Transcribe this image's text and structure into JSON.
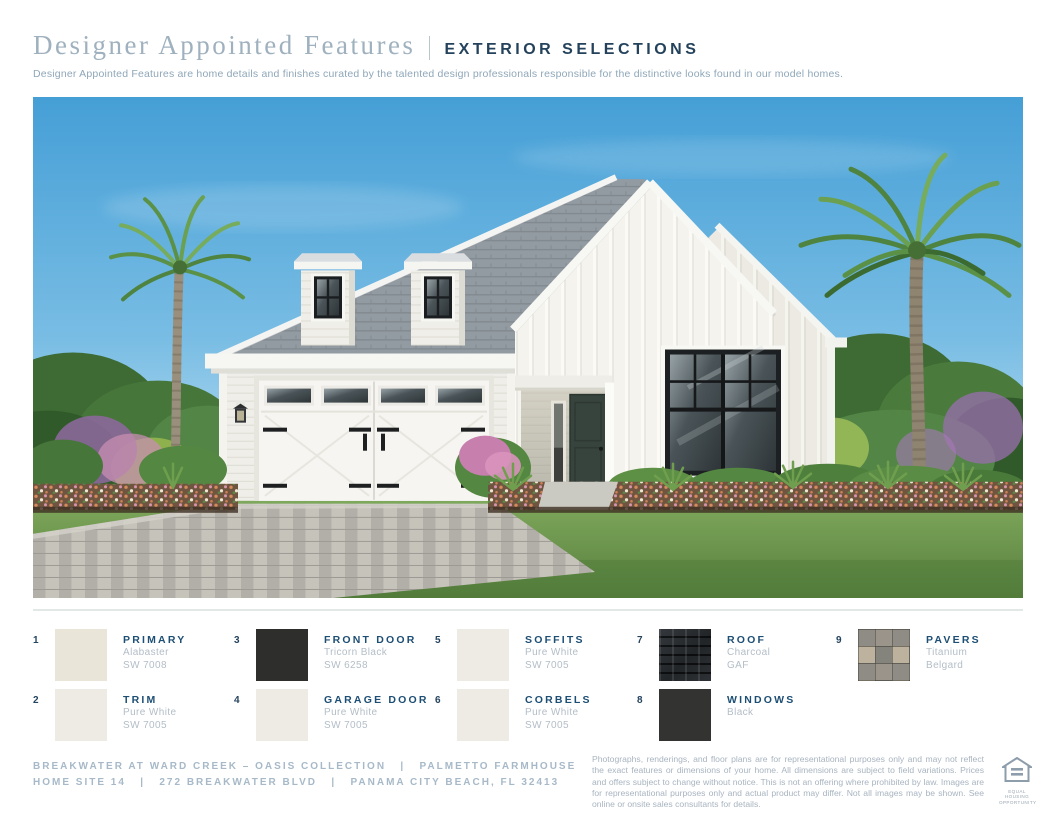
{
  "header": {
    "title_serif": "Designer Appointed Features",
    "title_divider": "|",
    "title_caps": "EXTERIOR SELECTIONS",
    "subtitle": "Designer Appointed Features are home details and finishes curated by the talented design professionals responsible for the distinctive looks found in our model homes."
  },
  "photo": {
    "description": "Rendering of a white board-and-batten modern farmhouse with black windows, charcoal shingle roof, white carriage garage doors, paver driveway, palm trees and flowering landscaping under a blue sky"
  },
  "colors": {
    "accent_navy": "#1d4e74",
    "title_gray_blue": "#9fb1be",
    "muted_text": "#b3bdc7",
    "alabaster": "#e9e5d9",
    "pure_white": "#edebe4",
    "tricorn_black": "#2e2e2d",
    "windows_black": "#333332"
  },
  "legend": {
    "items": [
      {
        "num": "1",
        "label": "PRIMARY",
        "line1": "Alabaster",
        "line2": "SW 7008",
        "swatch": {
          "type": "solid",
          "color": "#e9e5d9"
        },
        "col": 0,
        "row": 0
      },
      {
        "num": "2",
        "label": "TRIM",
        "line1": "Pure White",
        "line2": "SW 7005",
        "swatch": {
          "type": "solid",
          "color": "#edebe4"
        },
        "col": 0,
        "row": 1
      },
      {
        "num": "3",
        "label": "FRONT DOOR",
        "line1": "Tricorn Black",
        "line2": "SW 6258",
        "swatch": {
          "type": "solid",
          "color": "#2e2e2d"
        },
        "col": 1,
        "row": 0
      },
      {
        "num": "4",
        "label": "GARAGE DOOR",
        "line1": "Pure White",
        "line2": "SW 7005",
        "swatch": {
          "type": "solid",
          "color": "#edebe4"
        },
        "col": 1,
        "row": 1
      },
      {
        "num": "5",
        "label": "SOFFITS",
        "line1": "Pure White",
        "line2": "SW 7005",
        "swatch": {
          "type": "solid",
          "color": "#edebe4"
        },
        "col": 2,
        "row": 0
      },
      {
        "num": "6",
        "label": "CORBELS",
        "line1": "Pure White",
        "line2": "SW 7005",
        "swatch": {
          "type": "solid",
          "color": "#edebe4"
        },
        "col": 2,
        "row": 1
      },
      {
        "num": "7",
        "label": "ROOF",
        "line1": "Charcoal",
        "line2": "GAF",
        "swatch": {
          "type": "shingles",
          "color": "#26292c"
        },
        "col": 3,
        "row": 0
      },
      {
        "num": "8",
        "label": "WINDOWS",
        "line1": "Black",
        "line2": "",
        "swatch": {
          "type": "solid",
          "color": "#333332"
        },
        "col": 3,
        "row": 1
      },
      {
        "num": "9",
        "label": "PAVERS",
        "line1": "Titanium",
        "line2": "Belgard",
        "swatch": {
          "type": "pavers",
          "color": "#8f8d86"
        },
        "col": 4,
        "row": 0
      }
    ]
  },
  "footer": {
    "line1": "BREAKWATER AT WARD CREEK – OASIS COLLECTION   |   PALMETTO FARMHOUSE",
    "line2": "HOME SITE 14   |   272 BREAKWATER BLVD   |   PANAMA CITY BEACH, FL 32413",
    "disclaimer": "Photographs, renderings, and floor plans are for representational purposes only and may not reflect the exact features or dimensions of your home. All dimensions are subject to field variations. Prices and offers subject to change without notice. This is not an offering where prohibited by law. Images are for representational purposes only and actual product may differ. Not all images may be shown. See online or onsite sales consultants for details.",
    "eho_text": "EQUAL HOUSING\nOPPORTUNITY"
  }
}
